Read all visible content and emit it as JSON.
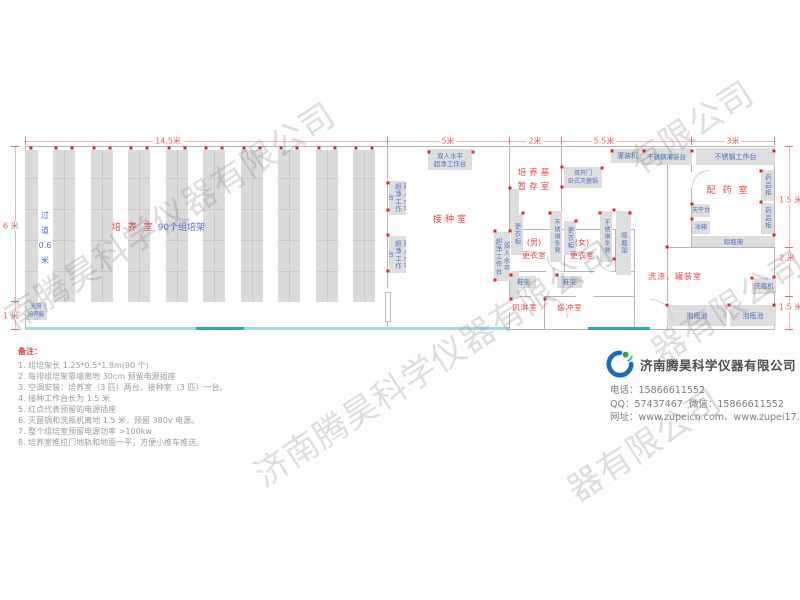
{
  "watermark": {
    "full": "济南腾昊科学仪器有限公司",
    "band_a": "南腾昊科学仪器有限公司",
    "band_c": "器有限公司",
    "band_e": "有限公司",
    "band_f": "器有限公司"
  },
  "plan": {
    "dims_top": [
      {
        "label": "14.5米",
        "x": 168
      },
      {
        "label": "5米",
        "x": 448
      },
      {
        "label": "2米",
        "x": 535
      },
      {
        "label": "5.5米",
        "x": 604
      },
      {
        "label": "3米",
        "x": 733
      }
    ],
    "dims_left": [
      {
        "label": "6 米",
        "y": 226
      },
      {
        "label": "1 米",
        "y": 316
      }
    ],
    "dims_right": [
      {
        "label": "1.5 米",
        "y": 200
      },
      {
        "label": "2 米",
        "y": 258
      },
      {
        "label": "1.5 米",
        "y": 307
      }
    ],
    "culture_label": {
      "main": "培 养 室",
      "sub": "90个组培架",
      "x": 112,
      "y": 220
    },
    "aisle_label": {
      "chars": [
        "过",
        "道",
        "0.6",
        "米"
      ],
      "x": 37,
      "y": 208
    },
    "room_labels": [
      {
        "lines": [
          "接种室"
        ],
        "x": 428,
        "y": 214,
        "w": 46,
        "fs": 9,
        "ls": 3
      },
      {
        "lines": [
          "培养基",
          "暂存室"
        ],
        "x": 512,
        "y": 166,
        "w": 46,
        "fs": 8.5,
        "ls": 3,
        "lh": 14
      },
      {
        "lines": [
          "(男)",
          "更衣室"
        ],
        "x": 518,
        "y": 236,
        "w": 32,
        "fs": 8,
        "ls": 0,
        "lh": 13
      },
      {
        "lines": [
          "(女)",
          "更衣室"
        ],
        "x": 566,
        "y": 236,
        "w": 32,
        "fs": 8,
        "ls": 0,
        "lh": 13
      },
      {
        "lines": [
          "风淋室"
        ],
        "x": 508,
        "y": 302,
        "w": 34,
        "fs": 7.5,
        "ls": 1
      },
      {
        "lines": [
          "缓冲室"
        ],
        "x": 553,
        "y": 302,
        "w": 34,
        "fs": 7.5,
        "ls": 1
      },
      {
        "lines": [
          "配 药 室"
        ],
        "x": 700,
        "y": 185,
        "w": 56,
        "fs": 9,
        "ls": 2
      },
      {
        "lines": [
          "洗涤、罐装室"
        ],
        "x": 646,
        "y": 271,
        "w": 58,
        "fs": 8,
        "ls": 1
      }
    ],
    "equipment": [
      {
        "label": "双人水平|超净工作台",
        "x": 428,
        "y": 149,
        "w": 44,
        "h": 21,
        "dir": "h",
        "fs": 6.5
      },
      {
        "label": "双人水平|超净工作台",
        "x": 389,
        "y": 181,
        "w": 17,
        "h": 34,
        "dir": "v",
        "fs": 6.5
      },
      {
        "label": "双人水平|超净工作台",
        "x": 389,
        "y": 236,
        "w": 17,
        "h": 37,
        "dir": "v",
        "fs": 6.5
      },
      {
        "label": "双人水平|超净工作台",
        "x": 494,
        "y": 232,
        "w": 16,
        "h": 49,
        "dir": "v",
        "fs": 6.5
      },
      {
        "label": "",
        "x": 510,
        "y": 189,
        "w": 9,
        "h": 42,
        "dir": "h"
      },
      {
        "label": "",
        "x": 510,
        "y": 271,
        "w": 9,
        "h": 28,
        "dir": "h"
      },
      {
        "label": "双开门|卧式灭菌锅",
        "x": 564,
        "y": 167,
        "w": 38,
        "h": 21,
        "dir": "h",
        "fs": 6
      },
      {
        "label": "灌装机",
        "x": 611,
        "y": 149,
        "w": 33,
        "h": 14,
        "dir": "h"
      },
      {
        "label": "不锈钢灌装台",
        "x": 641,
        "y": 148,
        "w": 51,
        "h": 17,
        "dir": "h",
        "fs": 6.5
      },
      {
        "label": "不锈钢工作台",
        "x": 696,
        "y": 148,
        "w": 79,
        "h": 17,
        "dir": "h"
      },
      {
        "label": "更衣柜",
        "x": 511,
        "y": 214,
        "w": 12,
        "h": 41,
        "dir": "v",
        "fs": 6.5
      },
      {
        "label": "不锈钢条凳",
        "x": 550,
        "y": 211,
        "w": 12,
        "h": 51,
        "dir": "v",
        "fs": 6
      },
      {
        "label": "更衣柜",
        "x": 564,
        "y": 221,
        "w": 12,
        "h": 34,
        "dir": "v",
        "fs": 6.5
      },
      {
        "label": "不锈钢条凳",
        "x": 600,
        "y": 211,
        "w": 12,
        "h": 51,
        "dir": "v",
        "fs": 6
      },
      {
        "label": "晾瓶架",
        "x": 616,
        "y": 211,
        "w": 15,
        "h": 64,
        "dir": "v",
        "fs": 6.5
      },
      {
        "label": "鞋架",
        "x": 511,
        "y": 276,
        "w": 25,
        "h": 12,
        "dir": "h",
        "fs": 6.5
      },
      {
        "label": "鞋架",
        "x": 557,
        "y": 276,
        "w": 25,
        "h": 12,
        "dir": "h",
        "fs": 6.5
      },
      {
        "label": "天平台",
        "x": 692,
        "y": 204,
        "w": 18,
        "h": 13,
        "dir": "h",
        "fs": 6
      },
      {
        "label": "冰箱",
        "x": 692,
        "y": 221,
        "w": 18,
        "h": 13,
        "dir": "h",
        "fs": 6
      },
      {
        "label": "药品柜",
        "x": 761,
        "y": 170,
        "w": 13,
        "h": 31,
        "dir": "v",
        "fs": 6.5
      },
      {
        "label": "药品柜",
        "x": 761,
        "y": 203,
        "w": 13,
        "h": 31,
        "dir": "v",
        "fs": 6.5
      },
      {
        "label": "晾瓶架",
        "x": 692,
        "y": 236,
        "w": 83,
        "h": 11,
        "dir": "h",
        "fs": 6.5
      },
      {
        "label": "洗瓶机",
        "x": 752,
        "y": 278,
        "w": 24,
        "h": 16,
        "dir": "h",
        "fs": 6.5
      },
      {
        "label": "泡瓶池",
        "x": 667,
        "y": 305,
        "w": 60,
        "h": 21,
        "dir": "h"
      },
      {
        "label": "泡瓶池",
        "x": 730,
        "y": 305,
        "w": 46,
        "h": 21,
        "dir": "h"
      },
      {
        "label": "光照|培养箱",
        "x": 25,
        "y": 302,
        "w": 22,
        "h": 18,
        "dir": "h",
        "fs": 5.5
      }
    ],
    "outlets": [
      [
        388,
        183
      ],
      [
        388,
        210
      ],
      [
        388,
        235
      ],
      [
        388,
        271
      ],
      [
        495,
        231
      ],
      [
        495,
        280
      ],
      [
        429,
        152
      ],
      [
        473,
        152
      ],
      [
        510,
        188
      ],
      [
        510,
        231
      ],
      [
        562,
        167
      ],
      [
        562,
        187
      ],
      [
        602,
        168
      ],
      [
        612,
        151
      ],
      [
        644,
        151
      ],
      [
        692,
        151
      ],
      [
        774,
        151
      ],
      [
        692,
        204
      ],
      [
        692,
        219
      ],
      [
        761,
        171
      ],
      [
        761,
        202
      ],
      [
        774,
        235
      ],
      [
        774,
        277
      ],
      [
        752,
        278
      ],
      [
        667,
        305
      ],
      [
        729,
        305
      ],
      [
        511,
        275
      ],
      [
        557,
        275
      ],
      [
        614,
        210
      ],
      [
        614,
        259
      ],
      [
        523,
        213
      ],
      [
        550,
        213
      ],
      [
        576,
        221
      ],
      [
        600,
        213
      ],
      [
        630,
        213
      ],
      [
        511,
        299
      ],
      [
        545,
        299
      ],
      [
        667,
        247
      ],
      [
        774,
        305
      ]
    ]
  },
  "notes": {
    "title": "备注：",
    "items": [
      "1. 组培架长 1.25*0.5*1.8m(90 个)",
      "2. 每排组培架靠墙离地 30cm 预留电源插座",
      "3. 空调安装：培养室（3 匹）两台，接种室（3 匹）一台。",
      "4. 接种工作台长为 1.5 米",
      "5. 红点代表预留的电源插座",
      "6. 灭菌锅和洗瓶机离地 1.5 米，预留 380v 电源。",
      "7. 整个组培室预留电源功率 >100kw",
      "8. 培养室推拉门地轨和地面一平，方便小推车推送。"
    ]
  },
  "company": {
    "name": "济南腾昊科学仪器有限公司",
    "phone_label": "电话：",
    "phone": "15866611552",
    "qq_label": "QQ：",
    "qq": "57437467",
    "wechat_label": "微信：",
    "wechat": "15866611552",
    "web_label": "网址：",
    "web": "www.zupeicn.com、www.zupei17.com"
  }
}
